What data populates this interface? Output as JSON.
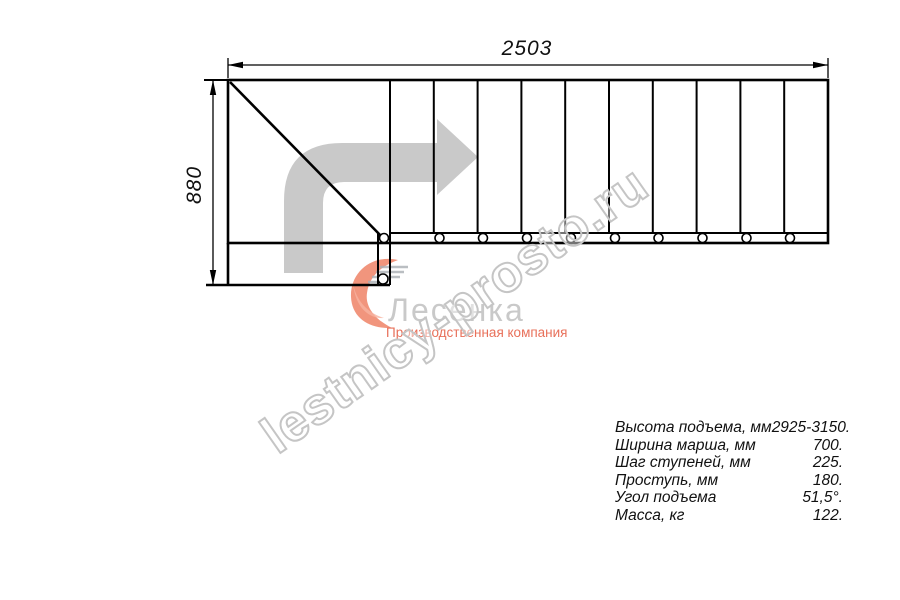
{
  "drawing": {
    "width_label": "2503",
    "height_label": "880"
  },
  "watermark": {
    "text": "lestnicy-prosto.ru"
  },
  "logo": {
    "name": "Лесенка",
    "tagline": "Производственная компания"
  },
  "specs": {
    "rows": [
      {
        "label": "Высота подъема, мм",
        "value": "2925-3150."
      },
      {
        "label": "Ширина марша, мм",
        "value": "700."
      },
      {
        "label": "Шаг ступеней, мм",
        "value": "225."
      },
      {
        "label": "Проступь, мм",
        "value": "180."
      },
      {
        "label": "Угол подъема",
        "value": "51,5°."
      },
      {
        "label": "Масса, кг",
        "value": "122."
      }
    ]
  },
  "colors": {
    "line": "#000000",
    "drawing-gray": "#c9c9c9",
    "watermark-gray": "#c5c5c5",
    "logo-salmon": "#ef8366",
    "logo-salmon-light": "#f7b3a0",
    "logo-text-gray": "#c9c9c9",
    "logo-red": "#e8705a"
  }
}
